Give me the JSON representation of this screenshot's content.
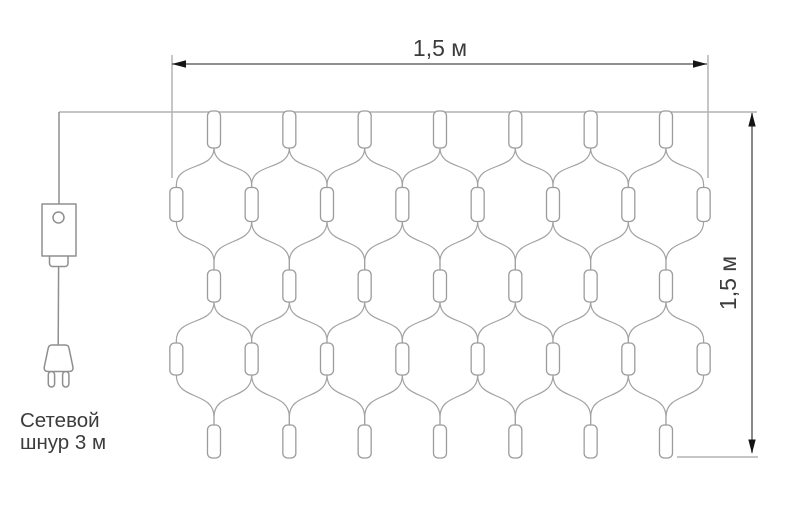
{
  "dimensions": {
    "width_label": "1,5 м",
    "height_label": "1,5 м"
  },
  "cord_label": {
    "line1": "Сетевой",
    "line2": "шнур 3 м"
  },
  "net": {
    "lamp_columns": 7,
    "side_columns": 8,
    "lamp_rows": 3,
    "side_rows": 2,
    "total_lamps": 37
  },
  "colors": {
    "background": "#ffffff",
    "net_line": "#a2a2a2",
    "lamp_stroke": "#9c9c9c",
    "lamp_fill": "#ffffff",
    "device_line": "#8f8f8f",
    "dimension_line": "#4c4c4c",
    "extension_line": "#b3b3b3",
    "arrow": "#141414",
    "text": "#3c3c3c"
  }
}
